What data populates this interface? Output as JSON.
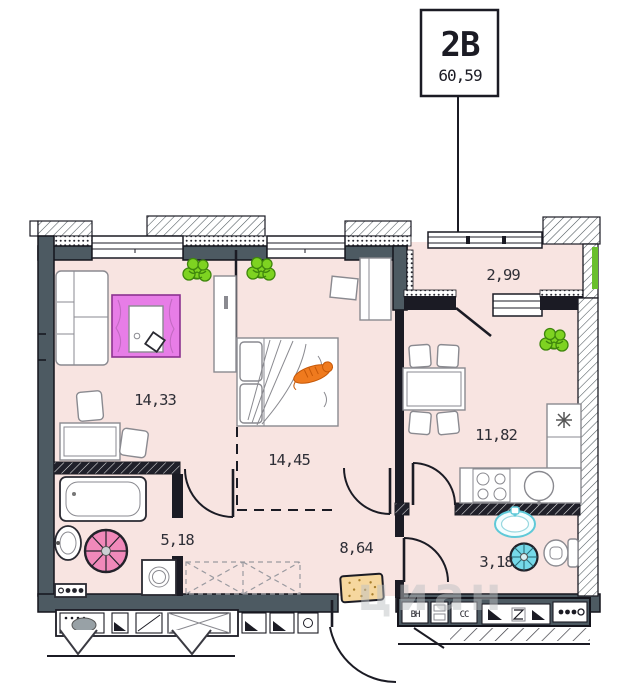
{
  "unit": {
    "code": "2В",
    "area": "60,59"
  },
  "rooms": {
    "living": {
      "area": "14,33"
    },
    "bedroom": {
      "area": "14,45"
    },
    "balcony": {
      "area": "2,99"
    },
    "kitchen": {
      "area": "11,82"
    },
    "bathroom": {
      "area": "5,18"
    },
    "hallway": {
      "area": "8,64"
    },
    "wc": {
      "area": "3,18"
    }
  },
  "shafts": {
    "vent": "ВН",
    "comms": "СС"
  },
  "watermark": "циан",
  "colors": {
    "floor": "#f8e4e1",
    "wall": "#4d5a62",
    "line": "#1b1b24",
    "rug": "#e77de7",
    "rug_border": "#8c3290",
    "plant": "#7ed321",
    "cat": "#ef7a1e",
    "mat": "#f6d79e",
    "stool_pink": "#f089ba",
    "stool_cyan": "#76d9e9",
    "fixture_cyan": "#5fc9d8",
    "balcony_green": "#6abf2e",
    "watermark": "#bfc2c4"
  }
}
